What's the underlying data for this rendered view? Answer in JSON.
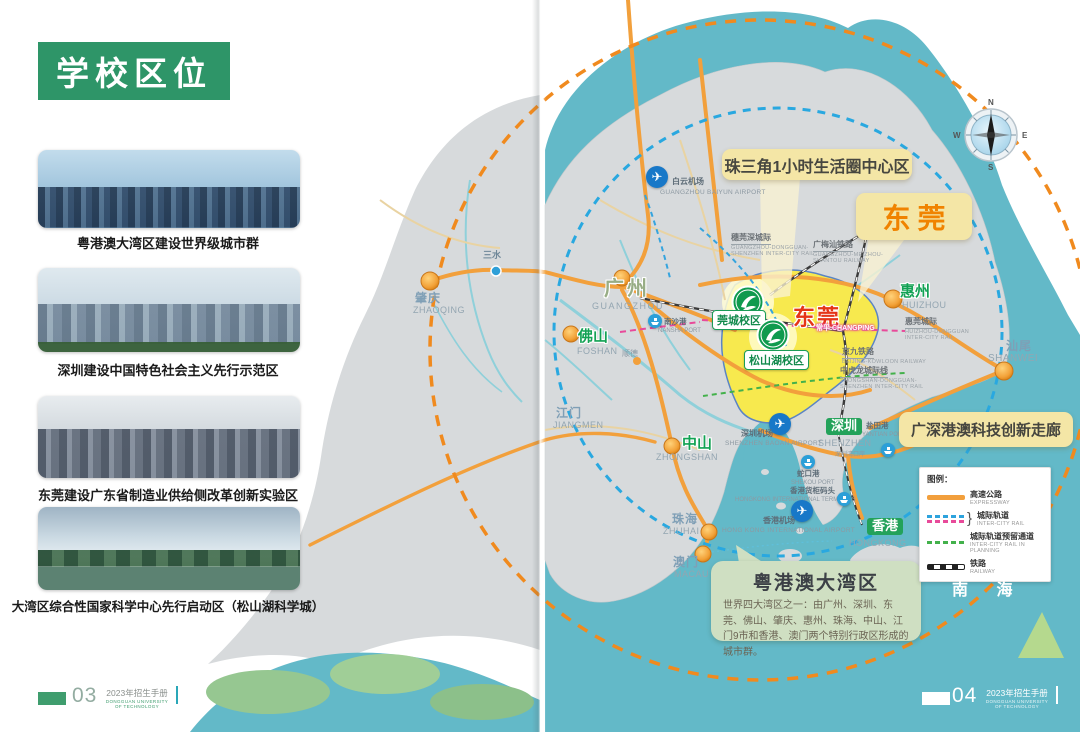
{
  "booklet": {
    "name_cn": "2023年招生手册",
    "name_en": "DONGGUAN UNIVERSITY OF TECHNOLOGY"
  },
  "left_page": {
    "section_title": "学校区位",
    "page_number": "03",
    "photos": [
      {
        "caption": "粤港澳大湾区建设世界级城市群"
      },
      {
        "caption": "深圳建设中国特色社会主义先行示范区"
      },
      {
        "caption": "东莞建设广东省制造业供给侧改革创新实验区"
      },
      {
        "caption": "大湾区综合性国家科学中心先行启动区（松山湖科学城）"
      }
    ]
  },
  "right_page": {
    "page_number": "04"
  },
  "map": {
    "callouts": {
      "life_circle": "珠三角1小时生活圈中心区",
      "dongguan": "东莞",
      "corridor": "广深港澳科技创新走廊",
      "bay_area_title": "粤港澳大湾区",
      "bay_area_body": "世界四大湾区之一：由广州、深圳、东莞、佛山、肇庆、惠州、珠海、中山、江门9市和香港、澳门两个特别行政区形成的城市群。"
    },
    "region_label": "东莞",
    "campuses": {
      "guancheng": "莞城校区",
      "songshanhu": "松山湖校区"
    },
    "cities": {
      "zhaoqing": {
        "cn": "肇庆",
        "en": "ZHAOQING"
      },
      "sanshui": {
        "cn": "三水"
      },
      "shunde": {
        "cn": "顺德"
      },
      "guangzhou": {
        "cn": "广州",
        "en": "GUANGZHOU"
      },
      "foshan": {
        "cn": "佛山",
        "en": "FOSHAN"
      },
      "huizhou": {
        "cn": "惠州",
        "en": "HUIZHOU"
      },
      "shanwei": {
        "cn": "汕尾",
        "en": "SHANWEI"
      },
      "zhongshan": {
        "cn": "中山",
        "en": "ZHONGSHAN"
      },
      "jiangmen": {
        "cn": "江门",
        "en": "JIANGMEN"
      },
      "zhuhai": {
        "cn": "珠海",
        "en": "ZHUHAI"
      },
      "macau": {
        "cn": "澳门",
        "en": "MACAU"
      },
      "shenzhen": {
        "cn": "深圳",
        "en": "SHENZHEN"
      },
      "hongkong": {
        "cn": "香港",
        "en": "HONGKONG"
      },
      "changping": {
        "cn": "常平",
        "en": "CHANGPING"
      }
    },
    "checkpoints": {
      "shenzhen_bay": {
        "cn": "深圳湾口岸"
      }
    },
    "airports": {
      "baiyun": {
        "cn": "白云机场",
        "en": "GUANGZHOU BAIYUN AIRPORT"
      },
      "baoan": {
        "cn": "深圳机场",
        "en": "SHENZHEN BAOAN AIRPORT"
      },
      "hongkong": {
        "cn": "香港机场",
        "en": "HONG KONG INTERNATIONAL AIRPORT"
      }
    },
    "ports": {
      "nansha": {
        "cn": "南沙港",
        "en": "NANSHA PORT"
      },
      "shekou": {
        "cn": "蛇口港",
        "en": "SHEKOU PORT"
      },
      "yantian": {
        "cn": "盐田港",
        "en": "YANTIAN PORT"
      },
      "hk_terminals": {
        "cn": "香港货柜码头",
        "en": "HONGKONG INTERNATIONAL TERMINALS"
      }
    },
    "railways": {
      "suiwanshen": {
        "cn": "穗莞深城际",
        "en1": "GUANGZHOU-DONGGUAN-",
        "en2": "SHENZHEN INTER-CITY RAIL"
      },
      "guangmeishan": {
        "cn": "广梅汕铁路",
        "en1": "GUANGZHOU-MEIZHOU-",
        "en2": "SHANTOU RAILWAY"
      },
      "huiwan": {
        "cn": "惠莞城际",
        "en1": "HUIZHOU-DONGGUAN",
        "en2": "INTER-CITY RAIL"
      },
      "jingjiu": {
        "cn": "京九铁路",
        "en1": "BEIJING-KOWLOON RAILWAY"
      },
      "zhonghulong": {
        "cn": "中虎龙城际线",
        "en1": "ZHONGSHAN-DONGGUAN-",
        "en2": "SHENZHEN INTER-CITY RAIL"
      }
    },
    "legend": {
      "title": "图例：",
      "brace": "}",
      "items": [
        {
          "cn": "高速公路",
          "en": "EXPRESSWAY"
        },
        {
          "cn": "城际轨道",
          "en": "INTER-CITY RAIL"
        },
        {
          "cn": "城际轨道预留通道",
          "en": "INTER-CITY RAIL IN PLANNING"
        },
        {
          "cn": "铁路",
          "en": "RAILWAY"
        }
      ]
    },
    "sea_label": "南 海",
    "compass": {
      "n": "N",
      "e": "E",
      "s": "S",
      "w": "W"
    },
    "icons": {
      "airplane": "✈"
    },
    "colors": {
      "accent_green": "#2E9568",
      "sea_teal": "#63B9C8",
      "dongguan_yellow": "#F7E94E",
      "expressway_orange": "#F29F3C",
      "callout_cream": "#F4E6A6",
      "region_red": "#E53517"
    }
  }
}
